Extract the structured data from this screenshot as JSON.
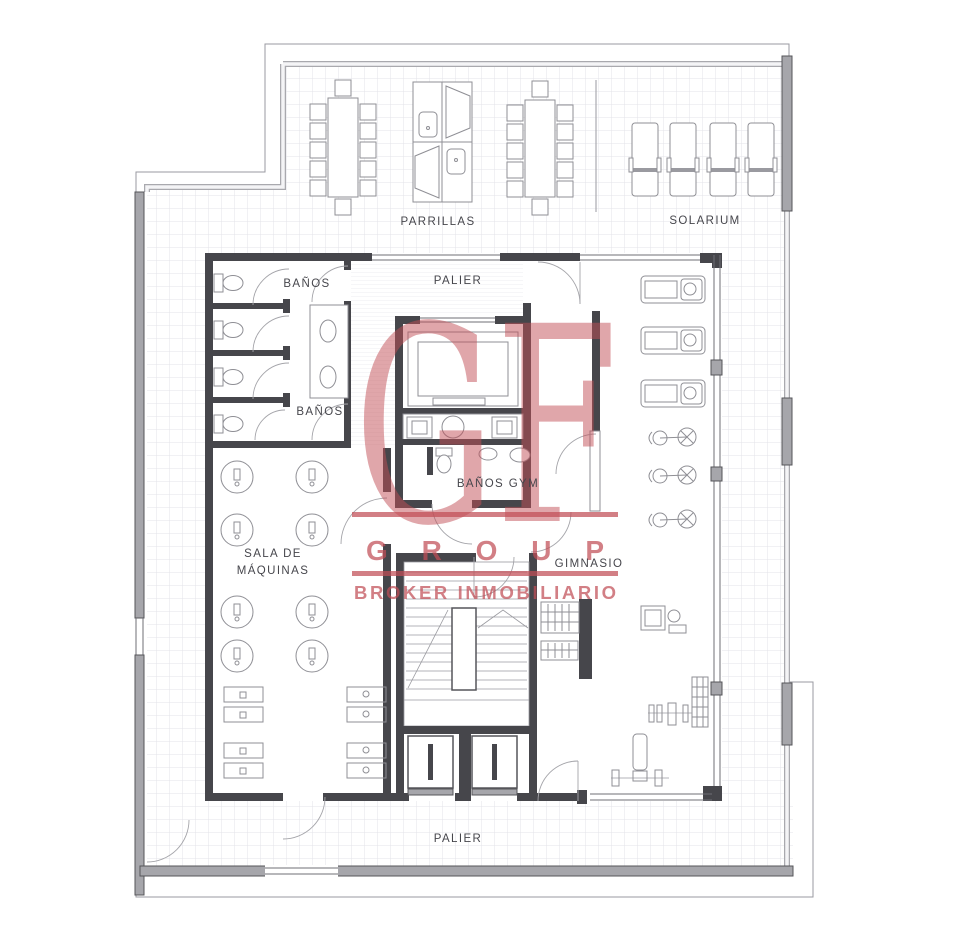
{
  "watermark": {
    "monogram": "GF",
    "group_text": "GROUP",
    "broker_text": "BROKER INMOBILIARIO",
    "color": "#c14e56"
  },
  "labels": [
    {
      "id": "parrillas",
      "text": "PARRILLAS",
      "x": 438,
      "y": 225
    },
    {
      "id": "solarium",
      "text": "SOLARIUM",
      "x": 705,
      "y": 224
    },
    {
      "id": "banos-top",
      "text": "BAÑOS",
      "x": 307,
      "y": 287
    },
    {
      "id": "palier-top",
      "text": "PALIER",
      "x": 458,
      "y": 284
    },
    {
      "id": "banos-lower",
      "text": "BAÑOS",
      "x": 320,
      "y": 415
    },
    {
      "id": "banos-gym",
      "text": "BAÑOS GYM",
      "x": 498,
      "y": 487
    },
    {
      "id": "sala-line-1",
      "text": "SALA DE",
      "x": 273,
      "y": 557
    },
    {
      "id": "sala-line-2",
      "text": "MÁQUINAS",
      "x": 273,
      "y": 574
    },
    {
      "id": "gimnasio",
      "text": "GIMNASIO",
      "x": 589,
      "y": 567
    },
    {
      "id": "palier-bottom",
      "text": "PALIER",
      "x": 458,
      "y": 842
    }
  ]
}
